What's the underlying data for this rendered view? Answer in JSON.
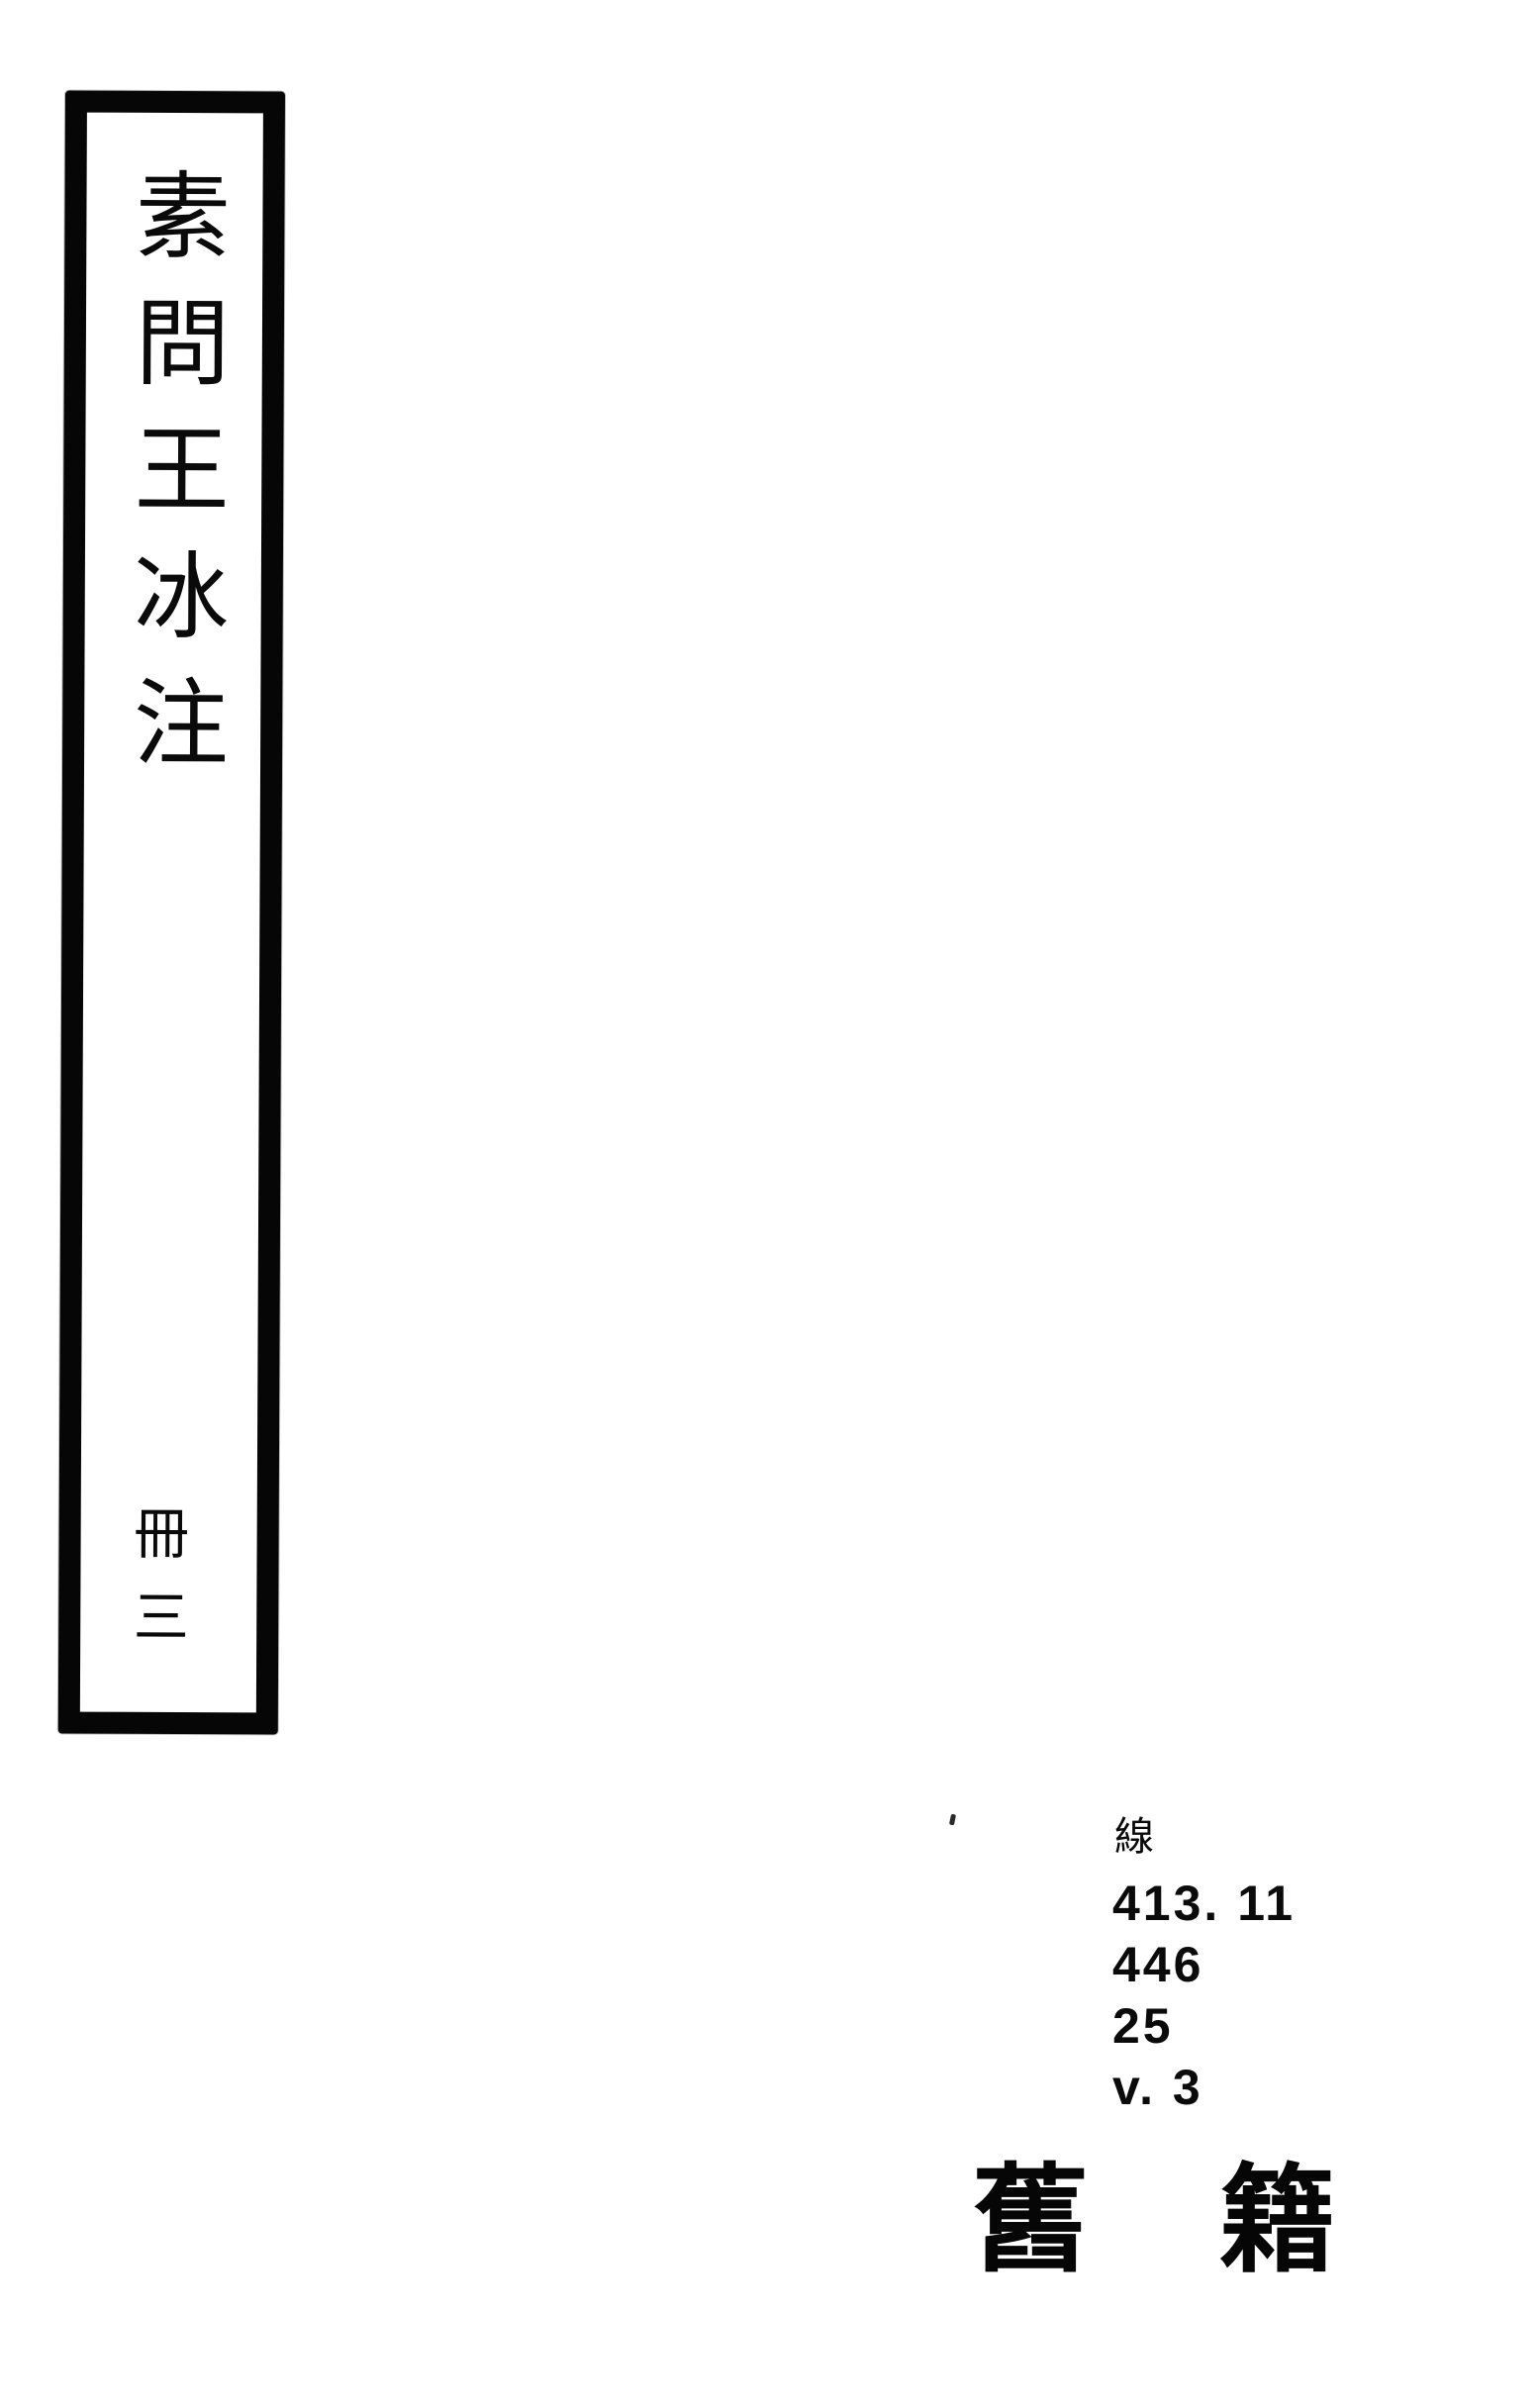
{
  "colors": {
    "ink": "#070707",
    "paper": "#ffffff"
  },
  "spine": {
    "title": "素問王冰注",
    "volume": "冊三"
  },
  "call_number": {
    "category": "線",
    "lines": [
      "413. 11",
      "446",
      "25",
      "v. 3"
    ]
  },
  "collection": {
    "text": "舊籍",
    "chars": [
      "舊",
      "籍"
    ]
  }
}
